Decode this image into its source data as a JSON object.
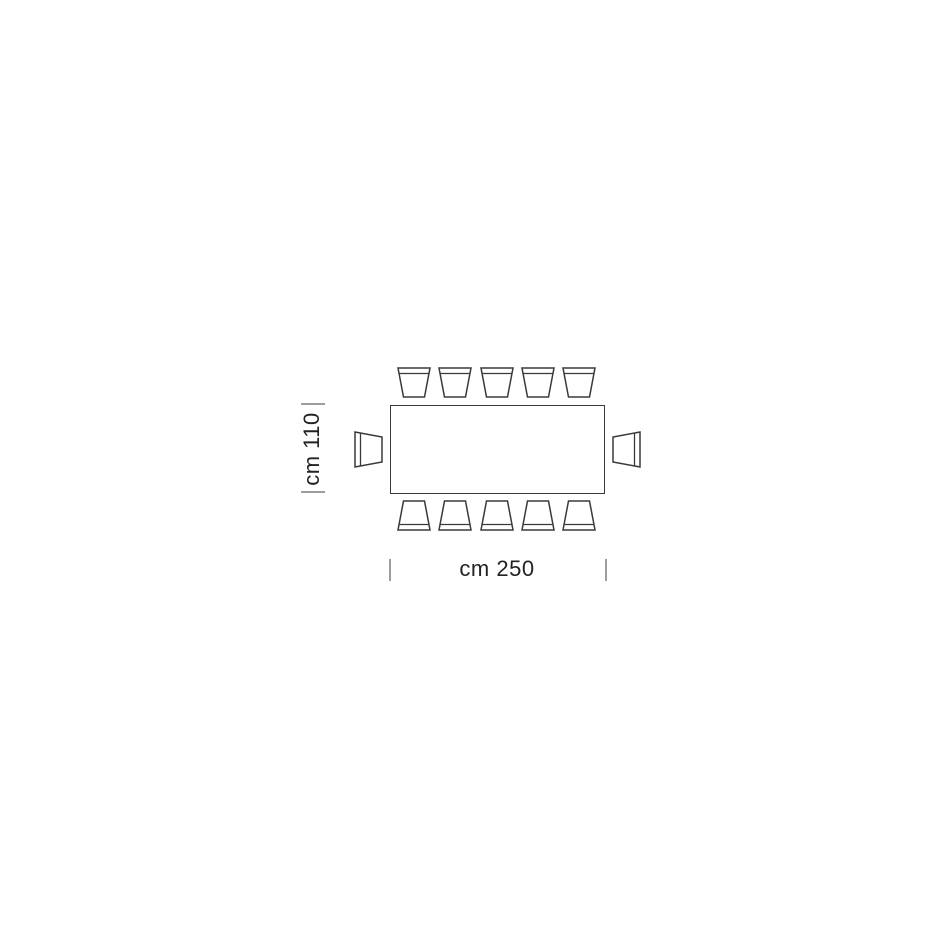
{
  "diagram": {
    "type": "furniture-floor-plan",
    "subject": "rectangular table with 12 chairs, top view dimension drawing",
    "table": {
      "shape": "rectangle",
      "width_cm": 250,
      "depth_cm": 110,
      "seats": 12
    },
    "chairs": {
      "top_count": 5,
      "bottom_count": 5,
      "left_count": 1,
      "right_count": 1
    },
    "dimensions": {
      "vertical": {
        "label": "cm 110"
      },
      "horizontal": {
        "label": "cm 250"
      }
    },
    "colors": {
      "background": "#ffffff",
      "line": "#3a3a3a",
      "tick": "#9d9d9d",
      "text": "#232323"
    }
  }
}
